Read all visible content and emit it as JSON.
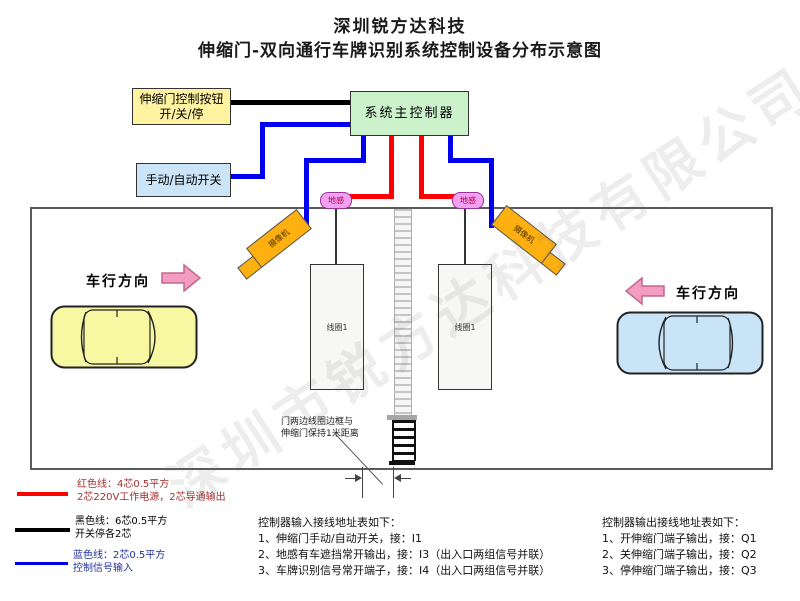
{
  "title": {
    "line1": "深圳锐方达科技",
    "line2": "伸缩门-双向通行车牌识别系统控制设备分布示意图"
  },
  "watermark": "深圳市锐方达科技有限公司",
  "devices": {
    "gate_button_line1": "伸缩门控制按钮",
    "gate_button_line2": "开/关/停",
    "main_controller": "系统主控制器",
    "manual_auto_switch": "手动/自动开关",
    "ground_sensor_left": "地感",
    "ground_sensor_right": "地感",
    "camera_left": "摄像机",
    "camera_right": "摄像机",
    "coil_left": "线圈1",
    "coil_right": "线圈1"
  },
  "lanes": {
    "left_direction_label": "车行方向",
    "right_direction_label": "车行方向"
  },
  "gate_note": {
    "line1": "门两边线圈边框与",
    "line2": "伸缩门保持1米距离"
  },
  "legend": [
    {
      "color": "#ff0000",
      "line1": "红色线：4芯0.5平方",
      "line2": "2芯220V工作电源，2芯导通输出"
    },
    {
      "color": "#000000",
      "line1": "黑色线：6芯0.5平方",
      "line2": "开关停各2芯"
    },
    {
      "color": "#0000ee",
      "line1": "蓝色线：2芯0.5平方",
      "line2": "控制信号输入"
    }
  ],
  "input_table": {
    "title": "控制器输入接线地址表如下：",
    "items": [
      "1、伸缩门手动/自动开关，接：I1",
      "2、地感有车遮挡常开输出，接：I3（出入口两组信号并联）",
      "3、车牌识别信号常开端子，接：I4（出入口两组信号并联）"
    ]
  },
  "output_table": {
    "title": "控制器输出接线地址表如下：",
    "items": [
      "1、开伸缩门端子输出，接：Q1",
      "2、关伸缩门端子输出，接：Q2",
      "3、停伸缩门端子输出，接：Q3"
    ]
  },
  "colors": {
    "wire_red": "#ff0000",
    "wire_blue": "#0000ee",
    "wire_black": "#000000",
    "box_yellow": "#fff2a0",
    "box_green": "#ccf2cc",
    "box_blue": "#cce4f7",
    "sensor_pink": "#f2a0f0",
    "camera_orange": "#ffb011",
    "arrow_pink": "#f49bc1",
    "car_yellow": "#f8f8a2",
    "car_blue": "#c9e3f7"
  }
}
